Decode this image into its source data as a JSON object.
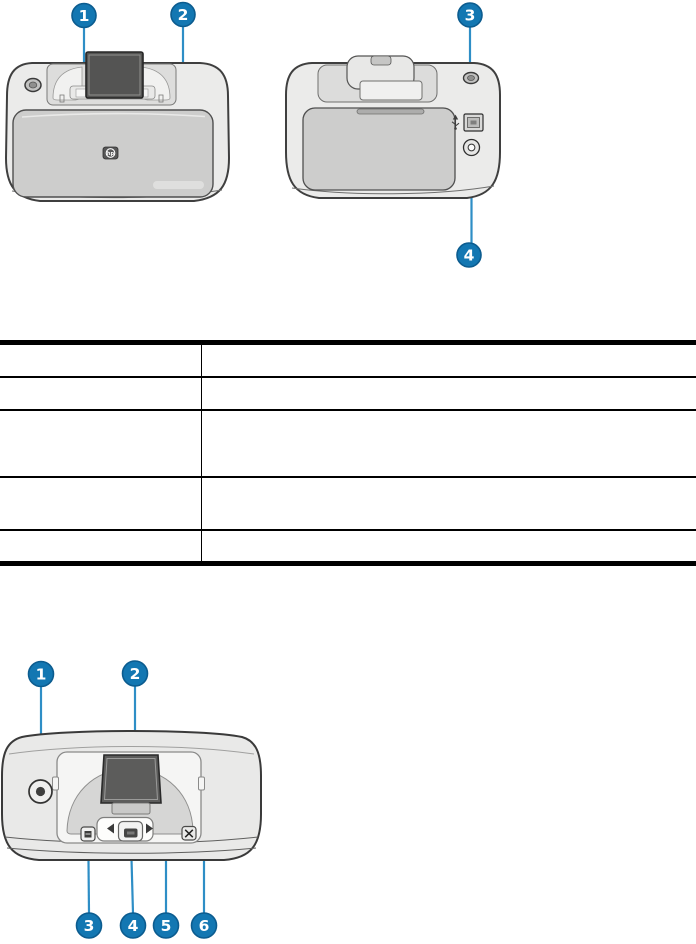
{
  "colors": {
    "callout_fill": "#1377b2",
    "callout_stroke": "#0c5c8f",
    "leader_line": "#2e8ec6",
    "table_border": "#000000",
    "printer_body": "#ebebea",
    "printer_door": "#cdcdcc",
    "screen": "#545453"
  },
  "figure_top": {
    "description_names": [
      "front-view",
      "back-view"
    ],
    "callouts": [
      {
        "number": "1"
      },
      {
        "number": "2"
      },
      {
        "number": "3"
      },
      {
        "number": "4"
      }
    ],
    "icons": {
      "hp_logo_text": "hp",
      "usb_icon": "usb-trident",
      "power_port_icon": "double-circle"
    }
  },
  "parts_table": {
    "columns": [
      "",
      ""
    ],
    "rows": [
      {
        "label": "",
        "description": ""
      },
      {
        "label": "",
        "description": ""
      },
      {
        "label": "",
        "description": ""
      },
      {
        "label": "",
        "description": ""
      },
      {
        "label": "",
        "description": ""
      }
    ]
  },
  "figure_bottom": {
    "description_names": [
      "control-panel-top-view"
    ],
    "callouts": [
      {
        "number": "1"
      },
      {
        "number": "2"
      },
      {
        "number": "3"
      },
      {
        "number": "4"
      },
      {
        "number": "5"
      },
      {
        "number": "6"
      }
    ],
    "icons": {
      "left_arrow_icon": "triangle-left",
      "right_arrow_icon": "triangle-right",
      "cancel_icon": "x-in-box",
      "print_icon": "small-square",
      "power_icon": "dot-in-circle"
    }
  }
}
